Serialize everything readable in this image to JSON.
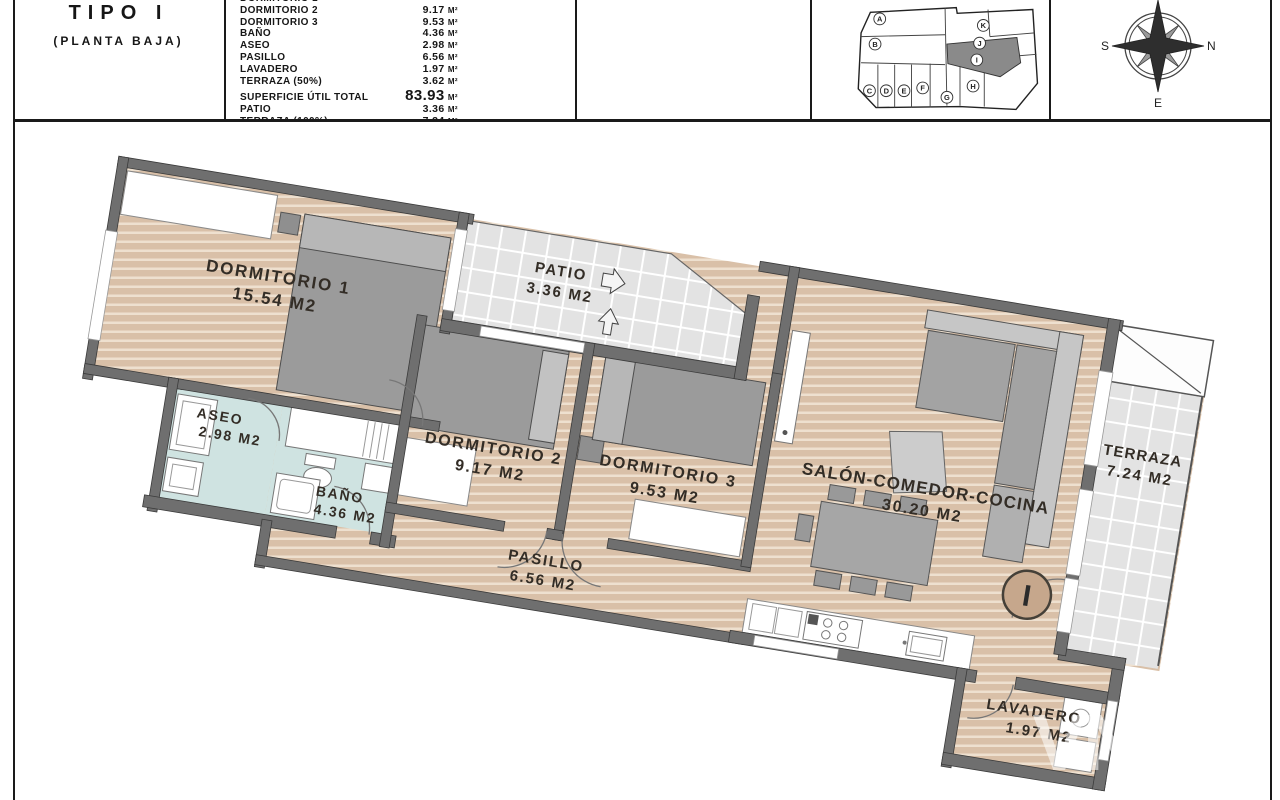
{
  "title_block": {
    "type_label": "TIPO I",
    "floor_label": "(PLANTA BAJA)",
    "area_table": {
      "rows": [
        {
          "label": "DORMITORIO 1",
          "value": "",
          "unit": ""
        },
        {
          "label": "DORMITORIO 2",
          "value": "9.17",
          "unit": "M²"
        },
        {
          "label": "DORMITORIO 3",
          "value": "9.53",
          "unit": "M²"
        },
        {
          "label": "BAÑO",
          "value": "4.36",
          "unit": "M²"
        },
        {
          "label": "ASEO",
          "value": "2.98",
          "unit": "M²"
        },
        {
          "label": "PASILLO",
          "value": "6.56",
          "unit": "M²"
        },
        {
          "label": "LAVADERO",
          "value": "1.97",
          "unit": "M²"
        },
        {
          "label": "TERRAZA (50%)",
          "value": "3.62",
          "unit": "M²"
        }
      ],
      "total_row": {
        "label": "SUPERFICIE ÚTIL TOTAL",
        "value": "83.93",
        "unit": "M²"
      },
      "extra_rows": [
        {
          "label": "PATIO",
          "value": "3.36",
          "unit": "M²"
        },
        {
          "label": "TERRAZA (100%)",
          "value": "7.24",
          "unit": "M²"
        }
      ]
    }
  },
  "key_plan": {
    "highlighted_unit": "I",
    "units": [
      {
        "letter": "A"
      },
      {
        "letter": "B"
      },
      {
        "letter": "C"
      },
      {
        "letter": "D"
      },
      {
        "letter": "E"
      },
      {
        "letter": "F"
      },
      {
        "letter": "G"
      },
      {
        "letter": "H"
      },
      {
        "letter": "I"
      },
      {
        "letter": "J"
      },
      {
        "letter": "K"
      }
    ]
  },
  "compass": {
    "left": "S",
    "right": "N",
    "bottom": "E"
  },
  "floor_plan": {
    "rooms": [
      {
        "name": "DORMITORIO 1",
        "area": "15.54 M2"
      },
      {
        "name": "PATIO",
        "area": "3.36 M2"
      },
      {
        "name": "ASEO",
        "area": "2.98 M2"
      },
      {
        "name": "BAÑO",
        "area": "4.36 M2"
      },
      {
        "name": "DORMITORIO 2",
        "area": "9.17 M2"
      },
      {
        "name": "DORMITORIO 3",
        "area": "9.53 M2"
      },
      {
        "name": "PASILLO",
        "area": "6.56 M2"
      },
      {
        "name": "SALÓN-COMEDOR-COCINA",
        "area": "30.20 M2"
      },
      {
        "name": "TERRAZA",
        "area": "7.24 M2"
      },
      {
        "name": "LAVADERO",
        "area": "1.97 M2"
      }
    ],
    "unit_marker": "I",
    "watermark": "VN"
  },
  "colors": {
    "wall": "#6f6f6f",
    "wood": "#d9c0a8",
    "wood_stripe": "#eee0cf",
    "bathroom_floor": "#cfe3e1",
    "tile": "#e3e3e3",
    "marker_fill": "#c6a78c",
    "line": "#1a1a1a"
  }
}
